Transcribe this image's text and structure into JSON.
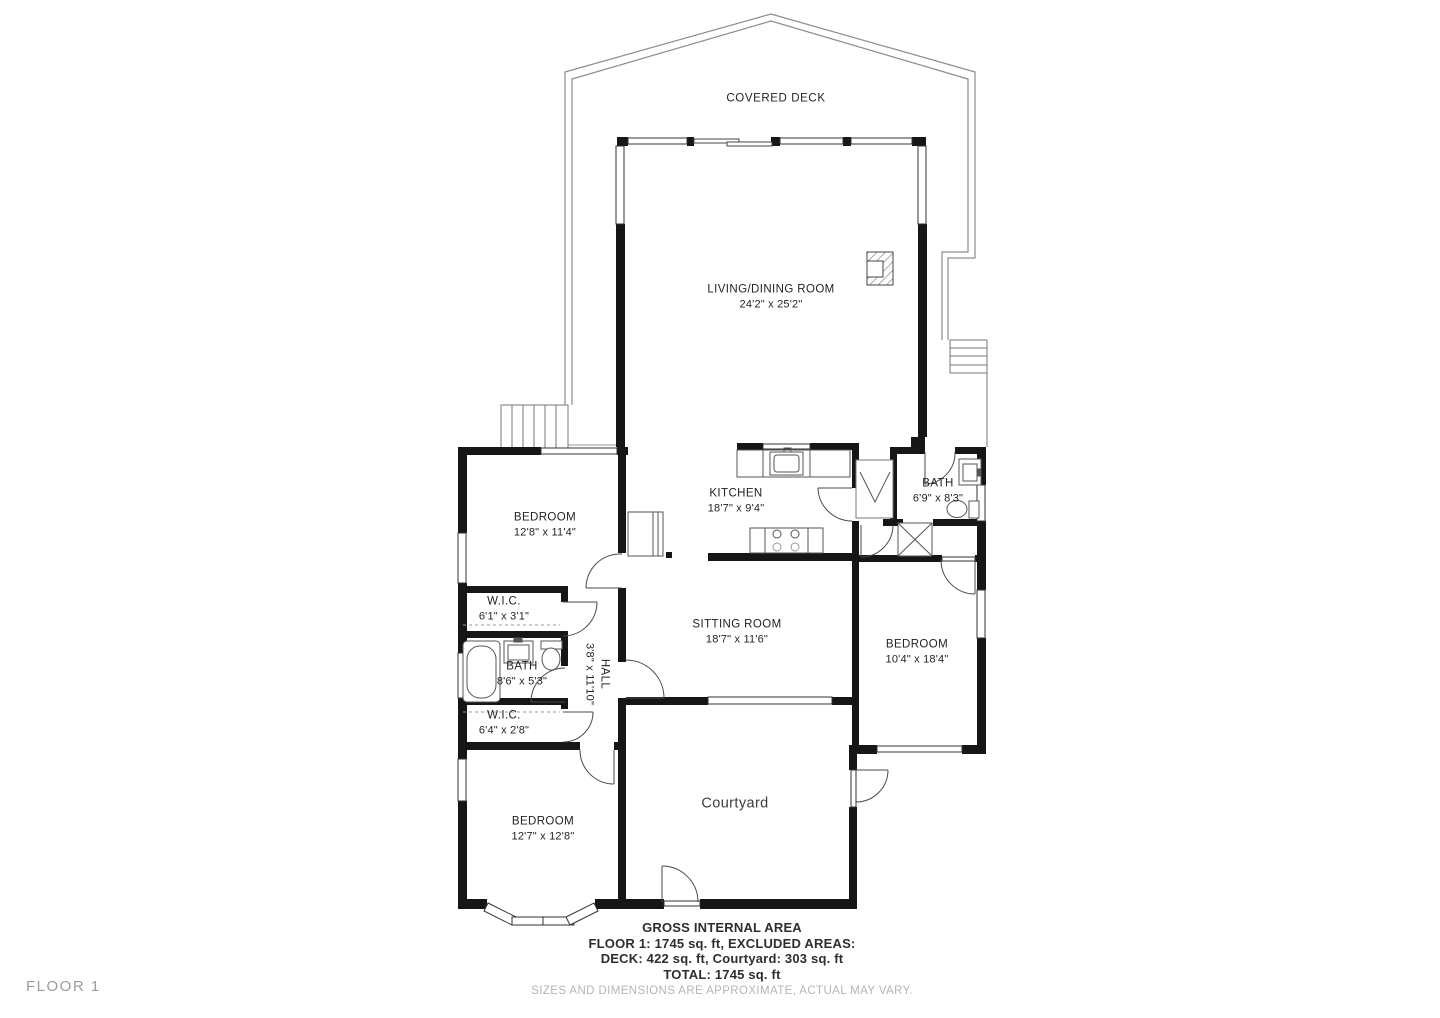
{
  "floor_label": "FLOOR 1",
  "rooms": {
    "covered_deck": {
      "name": "COVERED DECK",
      "dims": ""
    },
    "living_dining": {
      "name": "LIVING/DINING ROOM",
      "dims": "24'2\" x 25'2\""
    },
    "kitchen": {
      "name": "KITCHEN",
      "dims": "18'7\" x 9'4\""
    },
    "bath_upper": {
      "name": "BATH",
      "dims": "6'9\" x 8'3\""
    },
    "bedroom_left": {
      "name": "BEDROOM",
      "dims": "12'8\" x 11'4\""
    },
    "wic_upper": {
      "name": "W.I.C.",
      "dims": "6'1\" x 3'1\""
    },
    "bath_left": {
      "name": "BATH",
      "dims": "8'6\" x 5'3\""
    },
    "hall": {
      "name": "HALL",
      "dims": "3'8\" x 11'10\""
    },
    "sitting_room": {
      "name": "SITTING ROOM",
      "dims": "18'7\" x 11'6\""
    },
    "bedroom_right": {
      "name": "BEDROOM",
      "dims": "10'4\" x 18'4\""
    },
    "wic_lower": {
      "name": "W.I.C.",
      "dims": "6'4\" x 2'8\""
    },
    "bedroom_bottom": {
      "name": "BEDROOM",
      "dims": "12'7\" x 12'8\""
    },
    "courtyard": {
      "name": "Courtyard",
      "dims": ""
    }
  },
  "footer": {
    "line1": "GROSS INTERNAL AREA",
    "line2": "FLOOR 1: 1745 sq. ft, EXCLUDED AREAS:",
    "line3": "DECK: 422 sq. ft, Courtyard: 303 sq. ft",
    "line4": "TOTAL: 1745 sq. ft",
    "disclaimer": "SIZES AND DIMENSIONS ARE APPROXIMATE, ACTUAL MAY VARY."
  },
  "colors": {
    "wall": "#161616",
    "thin_line": "#555555",
    "deck_line": "#8d8d8d",
    "text": "#232323",
    "muted_text": "#b5b5b5",
    "floor_tag_text": "#9c9c9c"
  }
}
